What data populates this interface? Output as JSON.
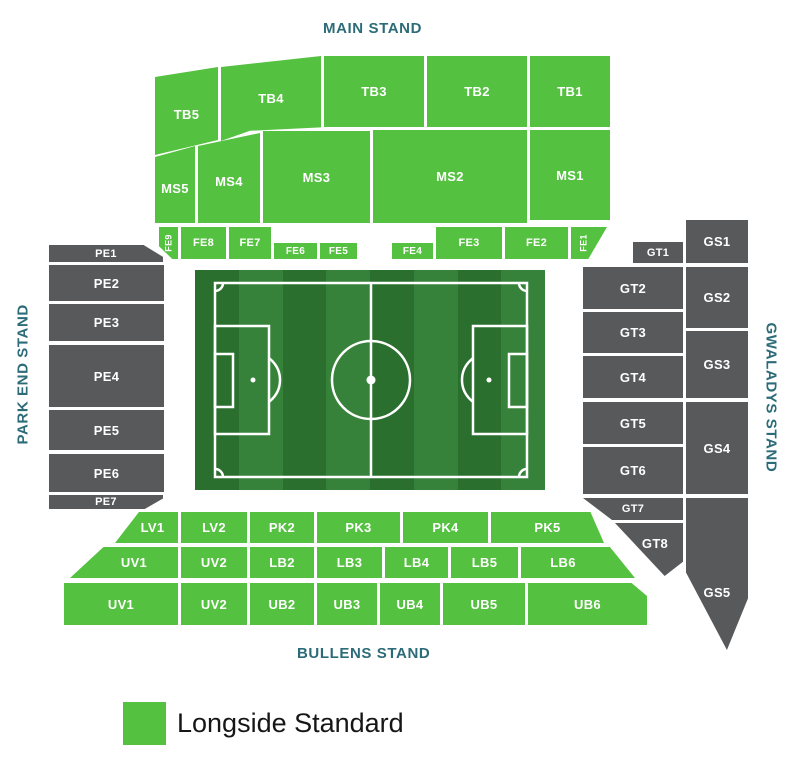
{
  "stands": {
    "main": "MAIN STAND",
    "park_end": "PARK END STAND",
    "gwaladys": "GWALADYS STAND",
    "bullens": "BULLENS STAND"
  },
  "legend": {
    "label": "Longside Standard",
    "swatch_color": "#55c140"
  },
  "colors": {
    "available": "#55c140",
    "unavailable": "#58595b",
    "stand_label": "#2c6b78",
    "pitch_dark": "#2b6f2e",
    "pitch_light": "#37823a"
  },
  "sections": {
    "tb5": "TB5",
    "tb4": "TB4",
    "tb3": "TB3",
    "tb2": "TB2",
    "tb1": "TB1",
    "ms5": "MS5",
    "ms4": "MS4",
    "ms3": "MS3",
    "ms2": "MS2",
    "ms1": "MS1",
    "fe9": "FE9",
    "fe8": "FE8",
    "fe7": "FE7",
    "fe6": "FE6",
    "fe5": "FE5",
    "fe4": "FE4",
    "fe3": "FE3",
    "fe2": "FE2",
    "fe1": "FE1",
    "pe1": "PE1",
    "pe2": "PE2",
    "pe3": "PE3",
    "pe4": "PE4",
    "pe5": "PE5",
    "pe6": "PE6",
    "pe7": "PE7",
    "gt1": "GT1",
    "gt2": "GT2",
    "gt3": "GT3",
    "gt4": "GT4",
    "gt5": "GT5",
    "gt6": "GT6",
    "gt7": "GT7",
    "gt8": "GT8",
    "gs1": "GS1",
    "gs2": "GS2",
    "gs3": "GS3",
    "gs4": "GS4",
    "gs5": "GS5",
    "lv1": "LV1",
    "lv2": "LV2",
    "pk2": "PK2",
    "pk3": "PK3",
    "pk4": "PK4",
    "pk5": "PK5",
    "uv1_upper": "UV1",
    "uv2_upper": "UV2",
    "lb2": "LB2",
    "lb3": "LB3",
    "lb4": "LB4",
    "lb5": "LB5",
    "lb6": "LB6",
    "uv1_lower": "UV1",
    "uv2_lower": "UV2",
    "ub2": "UB2",
    "ub3": "UB3",
    "ub4": "UB4",
    "ub5": "UB5",
    "ub6": "UB6"
  }
}
